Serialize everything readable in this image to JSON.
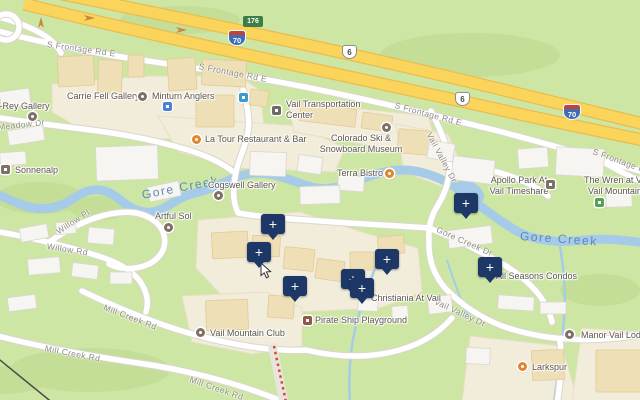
{
  "map": {
    "kind": "street-map-with-lodging-result-pins"
  },
  "markers": {
    "glyph": "+",
    "color": "#1d3867",
    "count": 8,
    "positions": [
      {
        "x": 466,
        "y": 203
      },
      {
        "x": 273,
        "y": 224
      },
      {
        "x": 259,
        "y": 252
      },
      {
        "x": 387,
        "y": 259
      },
      {
        "x": 490,
        "y": 267
      },
      {
        "x": 353,
        "y": 279
      },
      {
        "x": 295,
        "y": 286
      },
      {
        "x": 362,
        "y": 288
      }
    ]
  },
  "shields": {
    "interstate": "70",
    "us_route": "6",
    "exit_badge": "176"
  },
  "water": {
    "gore_creek": "Gore Creek"
  },
  "roads": {
    "s_frontage_rd_e": "S Frontage Rd E",
    "meadow_dr": "Meadow Dr",
    "vail_valley_dr": "Vail Valley Dr",
    "gore_creek_dr": "Gore Creek Dr",
    "willow_rd": "Willow Rd",
    "willow_pl": "Willow Pl",
    "mill_creek_rd": "Mill Creek Rd"
  },
  "pois": {
    "t_rey_gallery": "t-Rey Gallery",
    "carrie_fell_gallery": "Carrie Fell Gallery",
    "minturn_anglers": "Minturn Anglers",
    "vail_transportation_center": "Vail Transportation Center",
    "la_tour": "La Tour Restaurant & Bar",
    "ski_museum": "Colorado Ski & Snowboard Museum",
    "terra_bistro": "Terra Bistro",
    "sonnenalp": "Sonnenalp",
    "cogswell_gallery": "Cogswell Gallery",
    "artful_sol": "Artful Sol",
    "apollo_park": "Apollo Park At Vail Timeshare",
    "the_wren_line1": "The Wren at Vail",
    "the_wren_line2": "Vail Mountain",
    "all_seasons": "All Seasons Condos",
    "christiania": "Christiania At Vail",
    "manor_vail": "Manor Vail Lodge",
    "larkspur": "Larkspur",
    "pirate_ship": "Pirate Ship Playground",
    "vail_mountain_club": "Vail Mountain Club"
  },
  "icons": {
    "art_gallery": {
      "shape": "circle",
      "color": "#7d7165"
    },
    "restaurant": {
      "shape": "circle",
      "color": "#e2862e"
    },
    "lodging": {
      "shape": "square",
      "color": "#7d7165"
    },
    "museum": {
      "shape": "circle",
      "color": "#7d7165"
    },
    "shopping": {
      "shape": "square",
      "color": "#4e7fd6"
    },
    "transit_station": {
      "shape": "square",
      "color": "#3d9ad1"
    },
    "civic_building": {
      "shape": "square",
      "color": "#6e6a64"
    },
    "park": {
      "shape": "square",
      "color": "#55a05a"
    },
    "playground": {
      "shape": "square",
      "color": "#92564a"
    },
    "generic_poi": {
      "shape": "circle",
      "color": "#7d7165"
    }
  },
  "colors": {
    "landscape": "#cee6a4",
    "commercial_area": "#f2ecda",
    "water": "#a6cbe8",
    "highway_fill": "#fbd45c",
    "road_fill": "#ffffff",
    "marker": "#1d3867",
    "lift_line_red": "#d9482e"
  }
}
